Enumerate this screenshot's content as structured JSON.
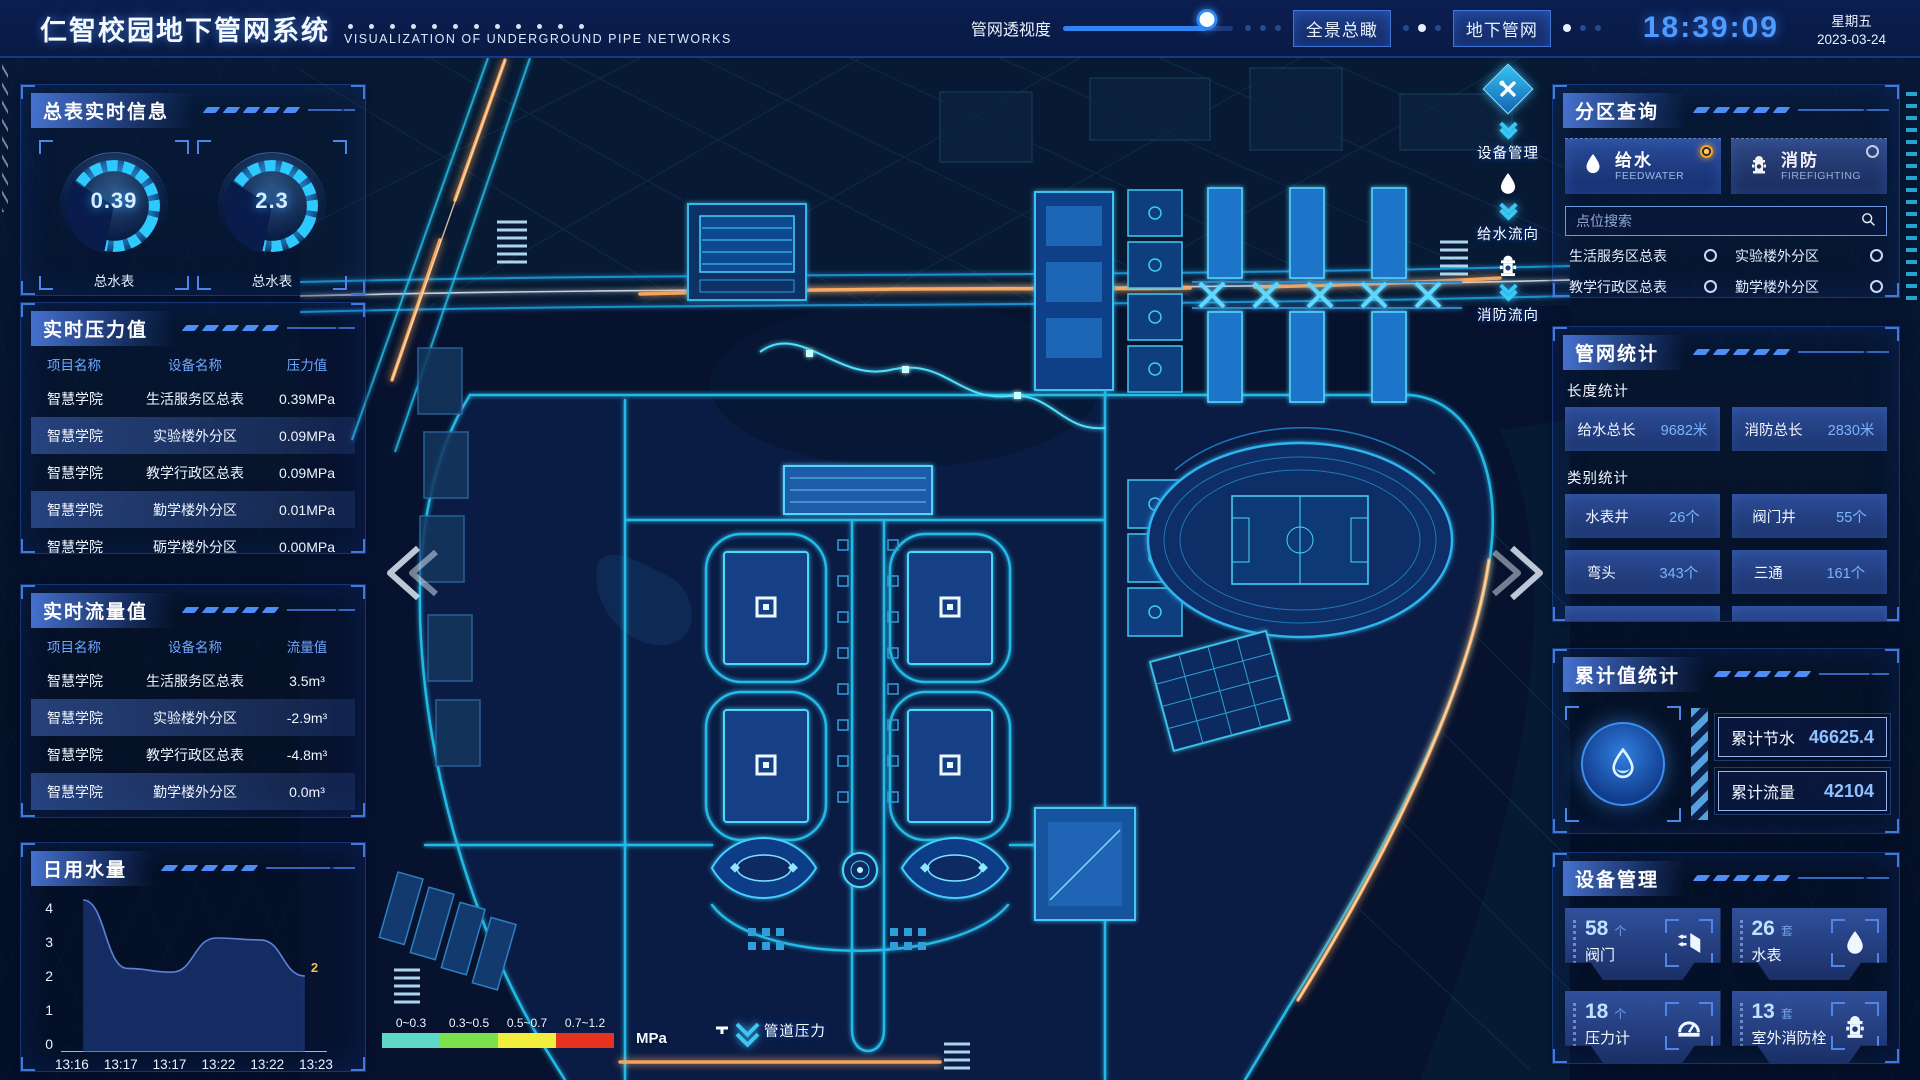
{
  "header": {
    "title": "仁智校园地下管网系统",
    "subtitle": "VISUALIZATION OF UNDERGROUND PIPE NETWORKS",
    "slider": {
      "label": "管网透视度",
      "value_pct": 85
    },
    "view_buttons": [
      {
        "label": "全景总瞰"
      },
      {
        "label": "地下管网"
      }
    ],
    "clock": {
      "time": "18:39:09",
      "weekday": "星期五",
      "date": "2023-03-24"
    }
  },
  "left": {
    "meter_panel": {
      "title": "总表实时信息",
      "gauges": [
        {
          "value": "0.39",
          "label1": "总水表",
          "label2": "当前压力值"
        },
        {
          "value": "2.3",
          "label1": "总水表",
          "label2": "瞬时流量"
        }
      ]
    },
    "pressure_panel": {
      "title": "实时压力值",
      "columns": [
        "项目名称",
        "设备名称",
        "压力值"
      ],
      "rows": [
        [
          "智慧学院",
          "生活服务区总表",
          "0.39MPa"
        ],
        [
          "智慧学院",
          "实验楼外分区",
          "0.09MPa"
        ],
        [
          "智慧学院",
          "教学行政区总表",
          "0.09MPa"
        ],
        [
          "智慧学院",
          "勤学楼外分区",
          "0.01MPa"
        ],
        [
          "智慧学院",
          "砺学楼外分区",
          "0.00MPa"
        ]
      ]
    },
    "flow_panel": {
      "title": "实时流量值",
      "columns": [
        "项目名称",
        "设备名称",
        "流量值"
      ],
      "rows": [
        [
          "智慧学院",
          "生活服务区总表",
          "3.5m³"
        ],
        [
          "智慧学院",
          "实验楼外分区",
          "-2.9m³"
        ],
        [
          "智慧学院",
          "教学行政区总表",
          "-4.8m³"
        ],
        [
          "智慧学院",
          "勤学楼外分区",
          "0.0m³"
        ],
        [
          "智慧学院",
          "砺学楼外分区",
          "2.3m³"
        ]
      ]
    },
    "daily_panel": {
      "title": "日用水量"
    }
  },
  "chart_data": {
    "type": "area",
    "title": "日用水量",
    "x": [
      "13:16",
      "13:17",
      "13:17",
      "13:22",
      "13:22",
      "13:23"
    ],
    "values": [
      4,
      2.2,
      2.1,
      3.0,
      2.95,
      2
    ],
    "end_label": "2",
    "ylim": [
      0,
      4
    ],
    "yticks": [
      0,
      1,
      2,
      3,
      4
    ],
    "grid": false,
    "line_color": "#5c82d8",
    "fill_color": "rgba(38,72,160,0.5)"
  },
  "map": {
    "tools": [
      {
        "label": "设备管理",
        "icon": "tools-icon"
      },
      {
        "label": "给水流向",
        "icon": "water-drop-icon"
      },
      {
        "label": "消防流向",
        "icon": "hydrant-icon"
      }
    ],
    "legend": {
      "title": "管道压力",
      "unit": "MPa",
      "ranges": [
        {
          "label": "0~0.3",
          "color": "#5ed9c8"
        },
        {
          "label": "0.3~0.5",
          "color": "#7be24b"
        },
        {
          "label": "0.5~0.7",
          "color": "#f2ee3e"
        },
        {
          "label": "0.7~1.2",
          "color": "#e5331f"
        }
      ]
    }
  },
  "right": {
    "zone_panel": {
      "title": "分区查询",
      "tabs": [
        {
          "label": "给水",
          "sub": "FEEDWATER",
          "selected": true
        },
        {
          "label": "消防",
          "sub": "FIREFIGHTING",
          "selected": false
        }
      ],
      "search_placeholder": "点位搜索",
      "items": [
        "生活服务区总表",
        "实验楼外分区",
        "教学行政区总表",
        "勤学楼外分区",
        "砺学楼外分区",
        "宿舍区泵房"
      ]
    },
    "stats_panel": {
      "title": "管网统计",
      "length_label": "长度统计",
      "length_stats": [
        {
          "name": "给水总长",
          "value": "9682米"
        },
        {
          "name": "消防总长",
          "value": "2830米"
        }
      ],
      "category_label": "类别统计",
      "category_stats": [
        {
          "name": "水表井",
          "value": "26个"
        },
        {
          "name": "阀门井",
          "value": "55个"
        },
        {
          "name": "弯头",
          "value": "343个"
        },
        {
          "name": "三通",
          "value": "161个"
        }
      ]
    },
    "accum_panel": {
      "title": "累计值统计",
      "rows": [
        {
          "name": "累计节水",
          "value": "46625.4"
        },
        {
          "name": "累计流量",
          "value": "42104"
        }
      ]
    },
    "device_panel": {
      "title": "设备管理",
      "cards": [
        {
          "count": "58",
          "unit": "个",
          "name": "阀门",
          "icon": "valve-icon"
        },
        {
          "count": "26",
          "unit": "套",
          "name": "水表",
          "icon": "water-meter-icon"
        },
        {
          "count": "18",
          "unit": "个",
          "name": "压力计",
          "icon": "pressure-gauge-icon"
        },
        {
          "count": "13",
          "unit": "套",
          "name": "室外消防栓",
          "icon": "outdoor-hydrant-icon"
        }
      ]
    }
  }
}
